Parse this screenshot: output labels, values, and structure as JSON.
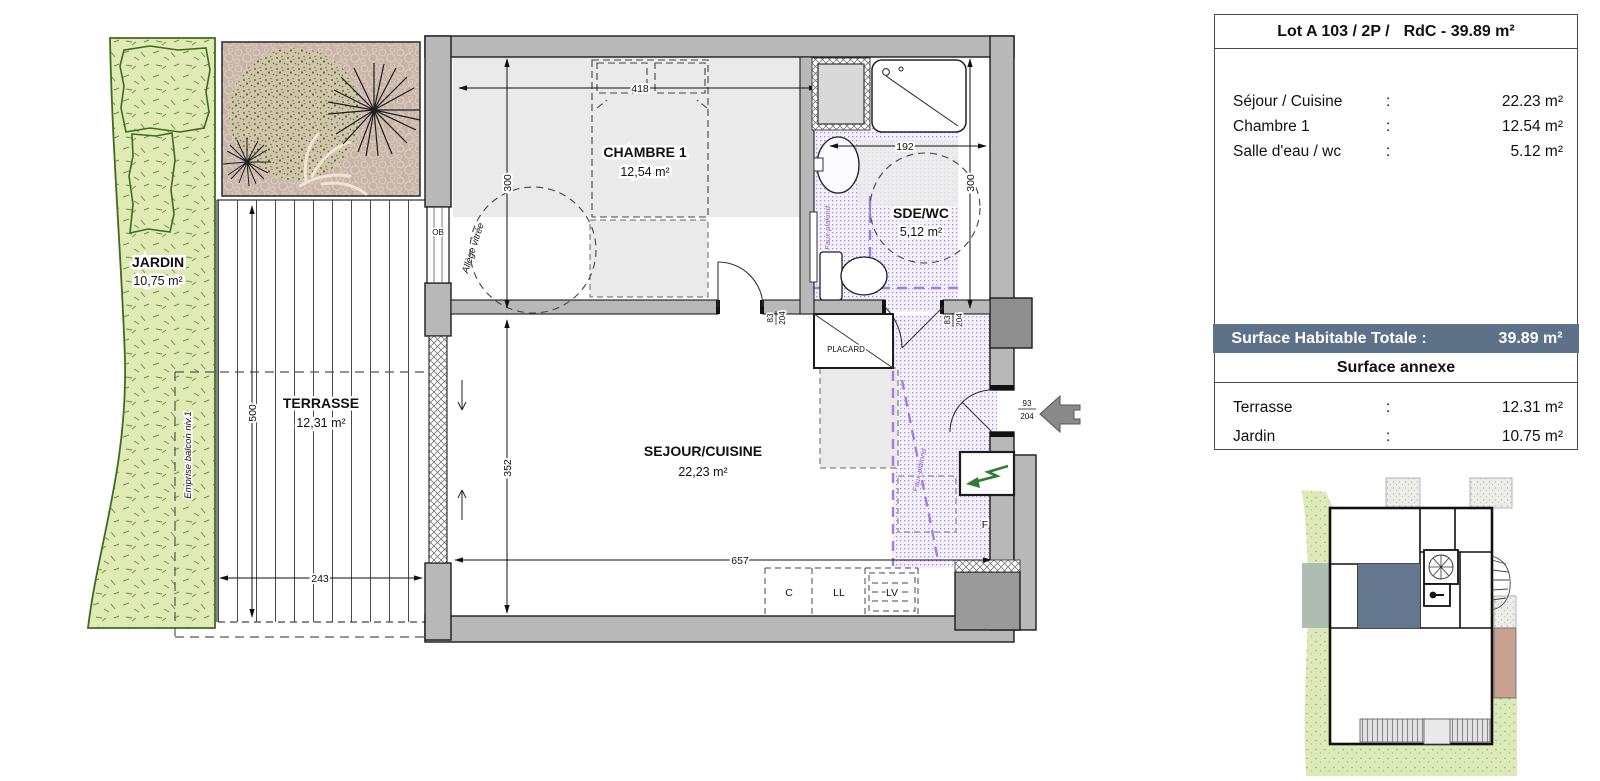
{
  "info": {
    "lot": "Lot A 103 / 2P /",
    "rdc": "RdC - 39.89 m²",
    "rooms": [
      {
        "label": "Séjour / Cuisine",
        "colon": ":",
        "value": "22.23 m²"
      },
      {
        "label": "Chambre 1",
        "colon": ":",
        "value": "12.54 m²"
      },
      {
        "label": "Salle d'eau / wc",
        "colon": ":",
        "value": "5.12 m²"
      }
    ],
    "total_label": "Surface Habitable Totale :",
    "total_value": "39.89 m²",
    "annexe_header": "Surface annexe",
    "annexe": [
      {
        "label": "Terrasse",
        "colon": ":",
        "value": "12.31 m²"
      },
      {
        "label": "Jardin",
        "colon": ":",
        "value": "10.75 m²"
      }
    ]
  },
  "plan": {
    "jardin": {
      "name": "JARDIN",
      "area": "10,75 m²"
    },
    "terrasse": {
      "name": "TERRASSE",
      "area": "12,31 m²"
    },
    "chambre": {
      "name": "CHAMBRE 1",
      "area": "12,54 m²"
    },
    "sde": {
      "name": "SDE/WC",
      "area": "5,12 m²"
    },
    "sejour": {
      "name": "SEJOUR/CUISINE",
      "area": "22,23 m²"
    },
    "placard": "PLACARD",
    "ob": "OB"
  },
  "dims": {
    "chambre_width": "418",
    "chambre_depth": "300",
    "sde_width": "192",
    "sde_depth": "300",
    "sejour_depth": "352",
    "sejour_width": "657",
    "terrasse_depth": "500",
    "terrasse_width": "243"
  },
  "doors": {
    "chambre": {
      "top": "83",
      "bottom": "204"
    },
    "sde": {
      "top": "83",
      "bottom": "204"
    },
    "entrance": {
      "top": "93",
      "bottom": "204"
    }
  },
  "annotations": {
    "allege": "Allège vitrée",
    "emprise": "Emprise balcon niv.1",
    "faux_plafond": "Faux-plafond"
  },
  "appliances": {
    "c": "C",
    "ll": "LL",
    "lv": "LV",
    "f": "F"
  },
  "colors": {
    "band_blue": "#5d7189",
    "unit_highlight": "#64778f",
    "wall_gray": "#b8b8b8",
    "garden_green": "#dfeab5",
    "purple": "#7b52c7"
  }
}
